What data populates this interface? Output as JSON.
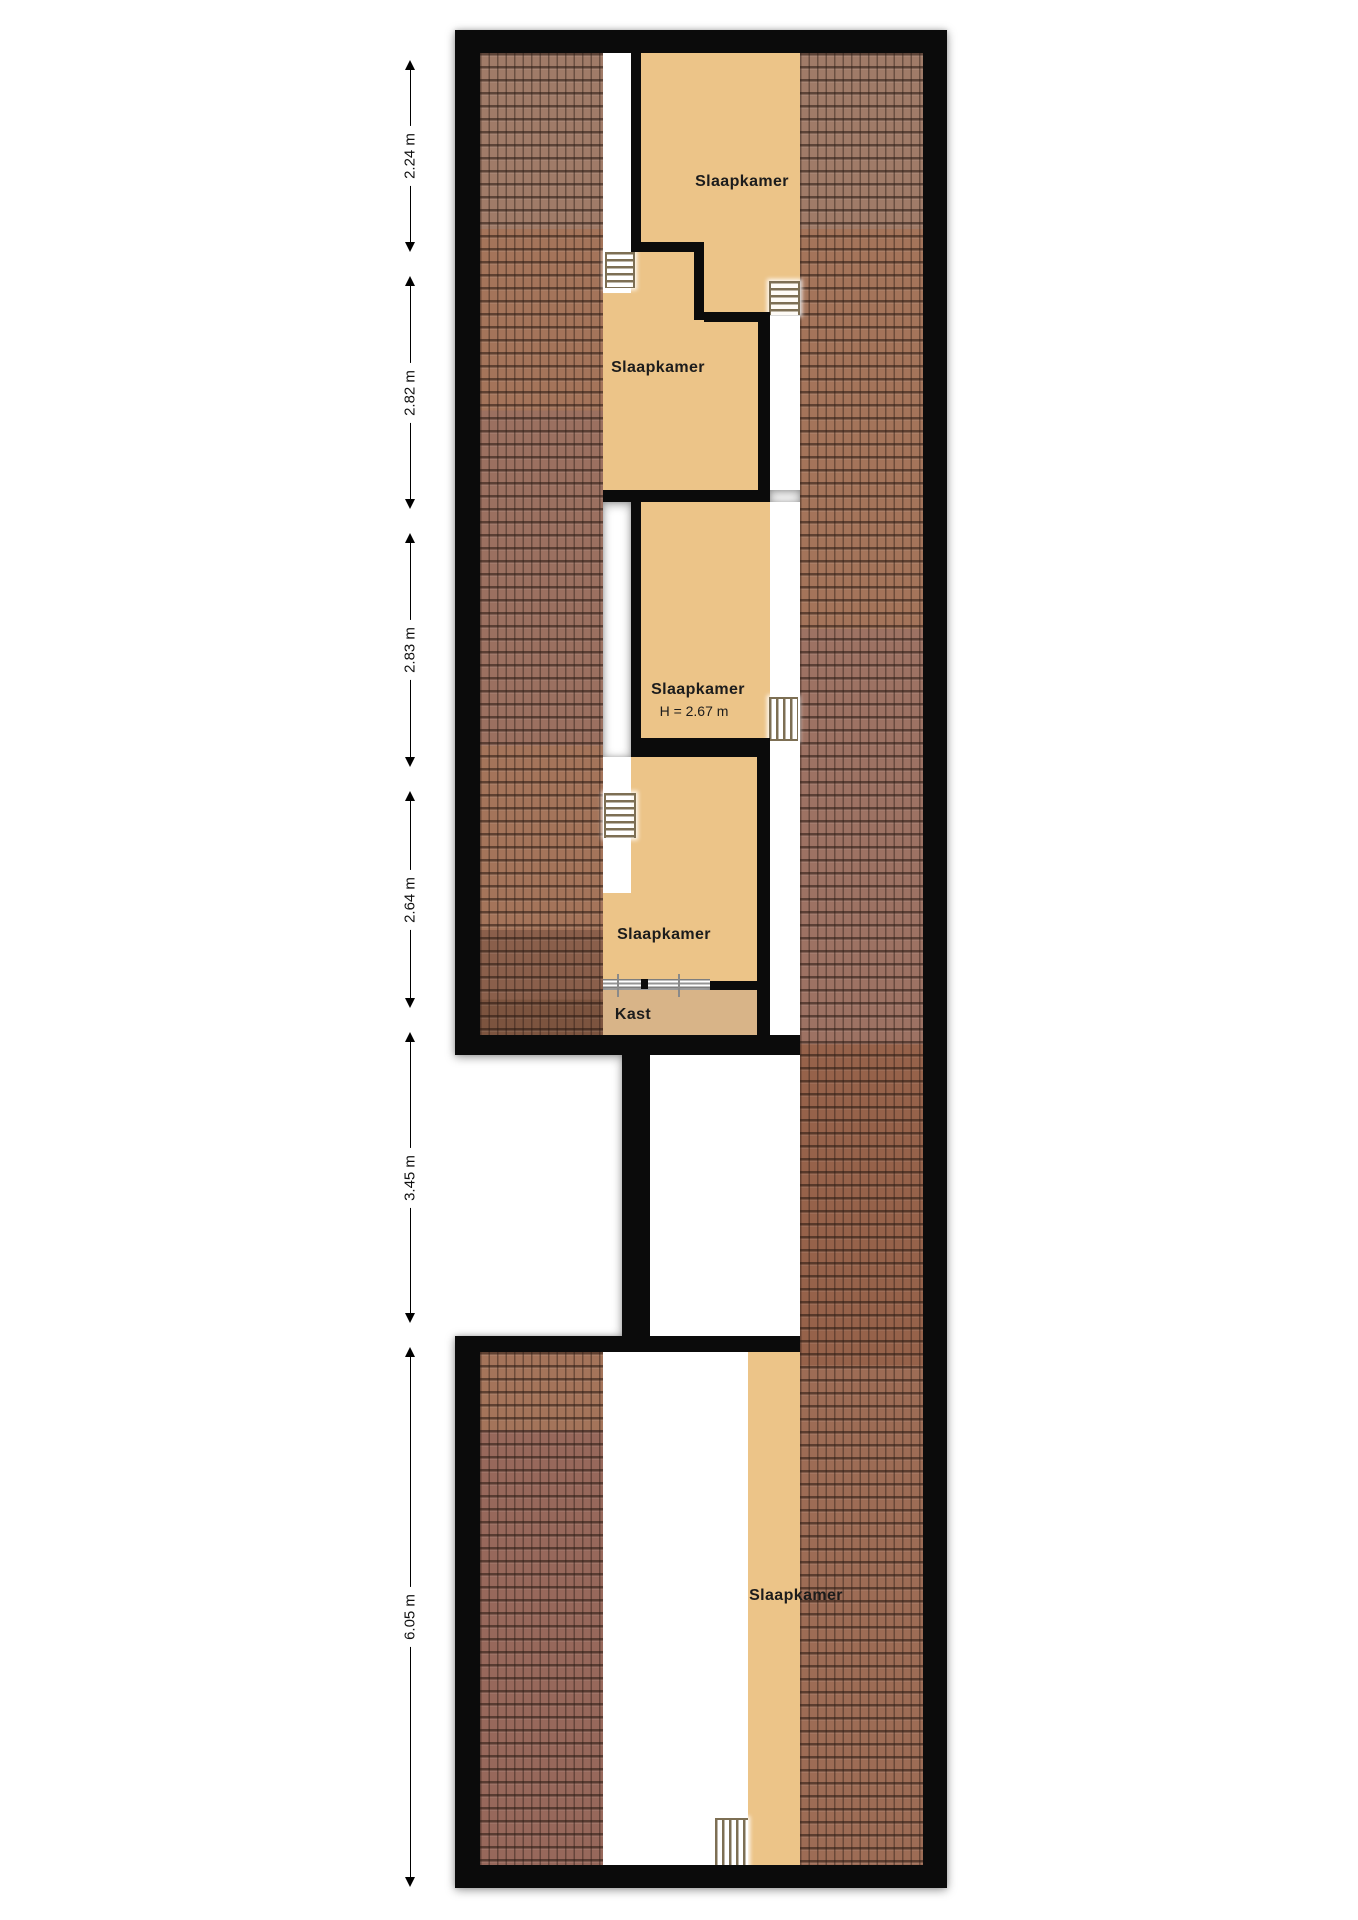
{
  "floorplan": {
    "type": "attic-floorplan",
    "language": "nl",
    "rooms": [
      {
        "id": "slaapkamer-1",
        "label": "Slaapkamer"
      },
      {
        "id": "slaapkamer-2",
        "label": "Slaapkamer"
      },
      {
        "id": "slaapkamer-3",
        "label": "Slaapkamer",
        "height_note": "H = 2.67 m"
      },
      {
        "id": "slaapkamer-4",
        "label": "Slaapkamer"
      },
      {
        "id": "kast",
        "label": "Kast"
      },
      {
        "id": "slaapkamer-5",
        "label": "Slaapkamer"
      }
    ],
    "dimensions": [
      {
        "label": "2.24 m"
      },
      {
        "label": "2.82 m"
      },
      {
        "label": "2.83 m"
      },
      {
        "label": "2.64 m"
      },
      {
        "label": "3.45 m"
      },
      {
        "label": "6.05 m"
      }
    ],
    "icons": [
      {
        "name": "stairs-icon",
        "count": 5
      }
    ],
    "colors": {
      "room_fill": "#ecc488",
      "closet_fill": "#d8b488",
      "wall": "#0b0b0b",
      "roof_base": "#a4745a",
      "ladder": "#7d6f54",
      "text": "#1c1c1c",
      "background": "#ffffff"
    }
  }
}
